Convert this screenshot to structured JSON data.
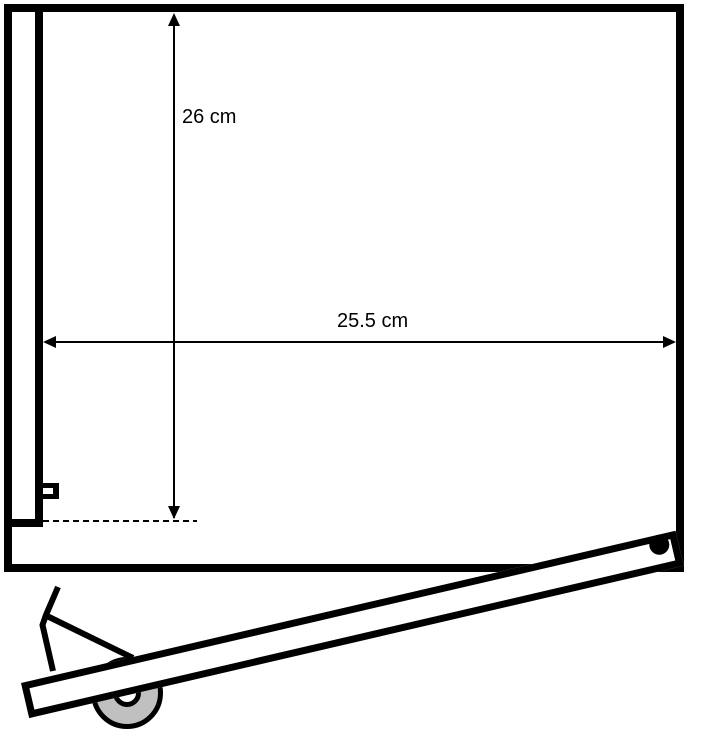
{
  "diagram": {
    "kind": "technical-line-drawing",
    "background_color": "#ffffff",
    "line_color": "#000000",
    "wheel_color": "#c0c0c0",
    "dimensions": {
      "height": {
        "label": "26 cm",
        "value": 26,
        "unit": "cm",
        "orientation": "vertical"
      },
      "width": {
        "label": "25.5 cm",
        "value": 25.5,
        "unit": "cm",
        "orientation": "horizontal"
      }
    },
    "parts": {
      "box": "open rectangular box outline with inner wall line, latch bracket and bottom-left step",
      "dashed_reference": "dashed horizontal reference line at inner wall base",
      "lever": "diagonal lever beam with black pivot dot near its upper-right end at the box corner",
      "wheel": "gray wheel with white hub under the lever near its left end",
      "handle": "bent handle with diagonal brace rising from the left end of the lever"
    }
  }
}
